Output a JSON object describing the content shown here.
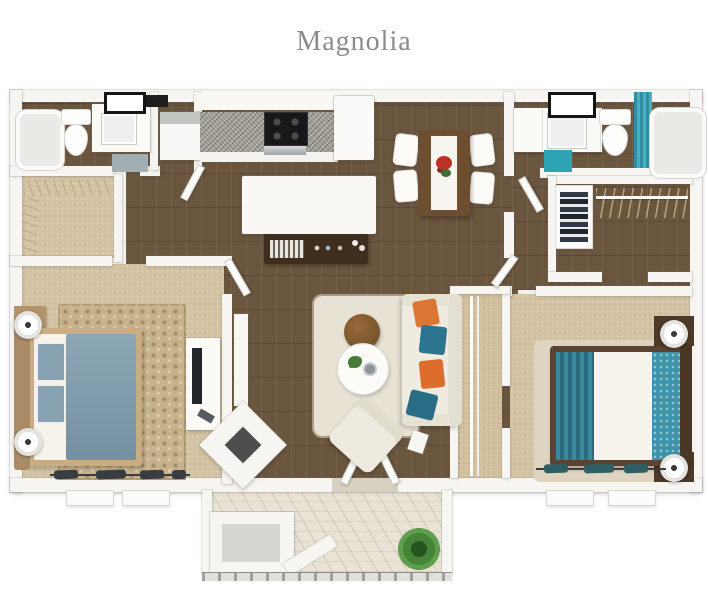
{
  "title": "Magnolia",
  "floor_plan": {
    "view": "3d-top-down-render",
    "unit_name": "Magnolia",
    "rooms": [
      {
        "name": "bathroom-left",
        "furniture": [
          "bathtub",
          "toilet",
          "vanity-with-sink",
          "framed-mirror",
          "gray-floor-mat"
        ]
      },
      {
        "name": "closet-left",
        "furniture": [
          "hanging-rods-with-hangers"
        ]
      },
      {
        "name": "laundry-nook",
        "furniture": [
          "washer-dryer"
        ]
      },
      {
        "name": "kitchen",
        "furniture": [
          "granite-counter",
          "stove",
          "refrigerator",
          "peninsula-counter",
          "dark-console-with-books"
        ]
      },
      {
        "name": "dining-area",
        "furniture": [
          "wood-dining-table",
          "white-table-runner",
          "floral-centerpiece",
          "four-white-chairs"
        ]
      },
      {
        "name": "bathroom-right",
        "furniture": [
          "vanity-with-sink",
          "framed-mirror",
          "toilet",
          "teal-shower-curtain",
          "bathtub",
          "teal-bath-mat"
        ]
      },
      {
        "name": "walk-in-closet-right",
        "furniture": [
          "shelving-with-clothes",
          "hanging-rod-with-hangers"
        ]
      },
      {
        "name": "bedroom-left",
        "furniture": [
          "bed-blue-duvet",
          "two-nightstands",
          "two-white-lamps",
          "damask-area-rug",
          "dresser-with-tv",
          "two-windows-dark-curtains"
        ]
      },
      {
        "name": "living-room",
        "furniture": [
          "cream-sofa",
          "orange-pillows",
          "teal-pillows",
          "round-brown-ottoman",
          "round-white-coffee-table",
          "accent-chair",
          "wall-console-table",
          "corner-fireplace",
          "cream-area-rug",
          "side-table"
        ]
      },
      {
        "name": "bedroom-right",
        "furniture": [
          "bed-teal-striped-blanket",
          "teal-patterned-pillows",
          "two-nightstands",
          "two-white-lamps",
          "area-rug",
          "reach-in-closet-with-rods",
          "two-windows-teal-curtains"
        ]
      },
      {
        "name": "patio",
        "furniture": [
          "diagonal-plank-deck",
          "storage-closet",
          "potted-plant",
          "railing",
          "french-doors"
        ]
      }
    ],
    "palette": {
      "title_text": "#8b8b8b",
      "wall": "#f6f5f1",
      "wood_floor": "#6a553e",
      "carpet": "#d2c2a2",
      "damask_rug": "#c7b28c",
      "living_rug": "#e7e2d4",
      "bedroom_right_rug": "#ded4bf",
      "patio_deck": "#e9e3d6",
      "duvet_blue": "#7c9aab",
      "bed_teal": "#3d93a8",
      "pillow_orange": "#dd7634",
      "pillow_teal": "#2c7490",
      "accent_teal_mat": "#2ea3b4",
      "shower_curtain_teal": "#49b0bf",
      "console_dark_wood": "#3f2d1d",
      "dining_table_wood": "#6e4e31",
      "plant_green": "#468539",
      "flowers_red": "#b93226"
    }
  }
}
